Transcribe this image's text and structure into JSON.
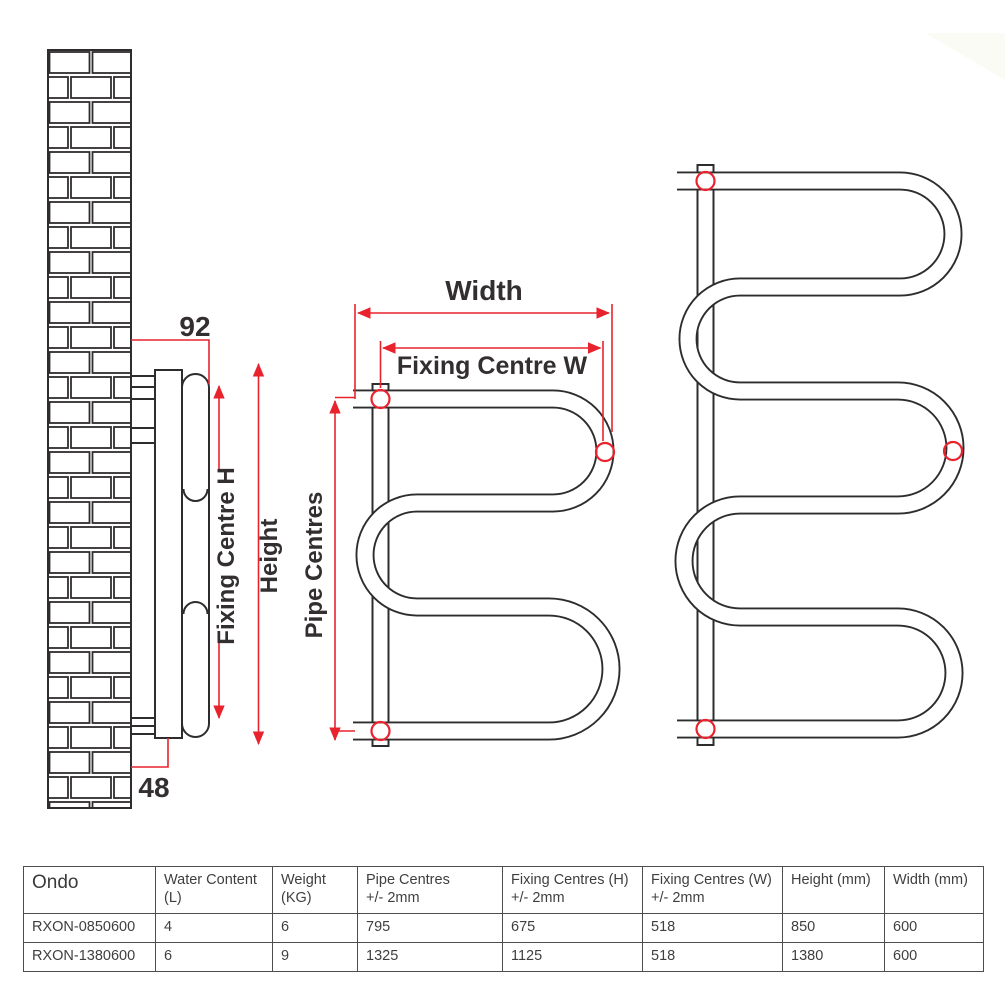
{
  "diagram": {
    "side_view": {
      "dim_92": "92",
      "dim_48": "48",
      "fixing_centre_h": "Fixing Centre H",
      "height": "Height"
    },
    "front_view": {
      "width": "Width",
      "fixing_centre_w": "Fixing Centre W",
      "pipe_centres": "Pipe Centres"
    },
    "colors": {
      "line": "#2f2c2d",
      "dimension_red": "#e8232e"
    }
  },
  "table": {
    "headers": [
      {
        "line1": "Ondo",
        "line2": ""
      },
      {
        "line1": "Water Content",
        "line2": "(L)"
      },
      {
        "line1": "Weight",
        "line2": "(KG)"
      },
      {
        "line1": "Pipe Centres",
        "line2": "+/- 2mm"
      },
      {
        "line1": "Fixing Centres (H)",
        "line2": "+/- 2mm"
      },
      {
        "line1": "Fixing Centres (W)",
        "line2": "+/- 2mm"
      },
      {
        "line1": "Height (mm)",
        "line2": ""
      },
      {
        "line1": "Width (mm)",
        "line2": ""
      }
    ],
    "rows": [
      [
        "RXON-0850600",
        "4",
        "6",
        "795",
        "675",
        "518",
        "850",
        "600"
      ],
      [
        "RXON-1380600",
        "6",
        "9",
        "1325",
        "1125",
        "518",
        "1380",
        "600"
      ]
    ]
  }
}
